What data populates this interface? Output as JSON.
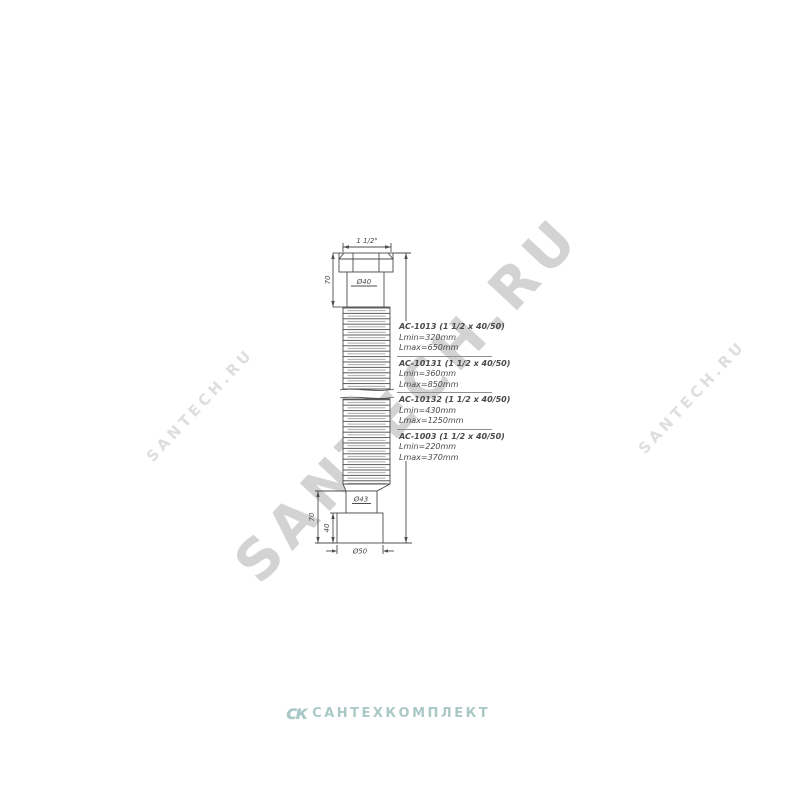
{
  "watermarks": {
    "center": "SANTECH.RU",
    "left": "SANTECH.RU",
    "right": "SANTECH.RU"
  },
  "footer": {
    "logo_monogram": "ск",
    "logo_text": "САНТЕХКОМПЛЕКТ",
    "logo_color": "#76a8a3"
  },
  "drawing": {
    "dims": {
      "thread": "1 1/2\"",
      "top_height": "70",
      "neck_diameter": "Ø40",
      "outlet_diameter": "Ø43",
      "outlet_height": "70",
      "cuff_height": "40",
      "cuff_diameter": "Ø50"
    },
    "variants": [
      {
        "code": "AC-1013 (1 1/2 x 40/50)",
        "lmin": "Lmin=320mm",
        "lmax": "Lmax=650mm"
      },
      {
        "code": "AC-10131 (1 1/2 x 40/50)",
        "lmin": "Lmin=360mm",
        "lmax": "Lmax=850mm"
      },
      {
        "code": "AC-10132 (1 1/2 x 40/50)",
        "lmin": "Lmin=430mm",
        "lmax": "Lmax=1250mm"
      },
      {
        "code": "AC-1003 (1 1/2 x 40/50)",
        "lmin": "Lmin=220mm",
        "lmax": "Lmax=370mm"
      }
    ]
  }
}
